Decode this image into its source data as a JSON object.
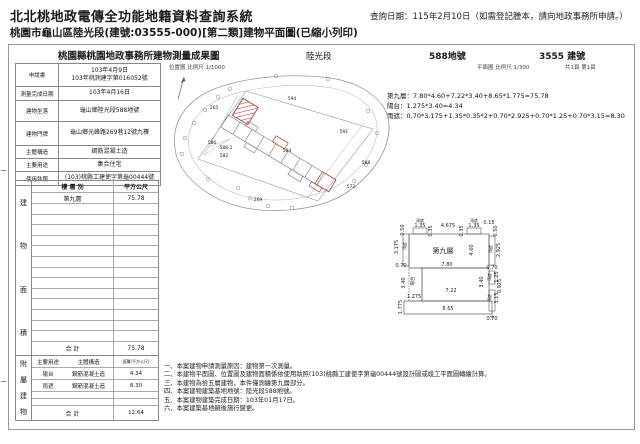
{
  "colors": {
    "accent_red": "#b0403a",
    "hatch_red": "#c05050",
    "line_gray": "#999999"
  },
  "page_header": {
    "system_title": "北北桃地政電傳全功能地籍資料查詢系統",
    "query_date": "查詢日期：115年2月10日（如需登記謄本，請向地政事務所申請。）",
    "subtitle": "桃園市龜山區陸光段(建號:03555-000)[第二類]建物平面圖(已縮小列印)"
  },
  "doc_header": {
    "office_title": "桃園縣桃園地政事務所建物測量成果圖",
    "section": "陸光段",
    "parcel": "588地號",
    "building_no": "3555 建號",
    "location_scale": "位置圖 比例尺 1/1000",
    "plan_scale": "平面圖 比例尺 1/300",
    "pages": "共1頁 第1頁"
  },
  "info_table": {
    "rows": [
      {
        "label": "申請書",
        "value": "103年4月9日\n103年桃測建字第016052號"
      },
      {
        "label": "測量完成日期",
        "value": "103年4月16日"
      },
      {
        "label": "建物坐落",
        "value": "龜山鄉陸光段588地號"
      },
      {
        "label": "建物門牌",
        "value": "龜山鄉光峰路269巷12號九樓"
      },
      {
        "label": "主體構造",
        "value": "鋼筋混凝土造"
      },
      {
        "label": "主要用途",
        "value": "集合住宅"
      },
      {
        "label": "使用執照",
        "value": "(103)桃縣工建使字第龜00444號"
      }
    ]
  },
  "floor_table": {
    "side_label": "建物面積",
    "col_floor": "樓 層 別",
    "col_area": "平方公尺",
    "rows": [
      {
        "floor": "第九層",
        "area": "75.78"
      }
    ],
    "empty_rows": 13,
    "total_label": "合  計",
    "total": "75.78"
  },
  "annex_table": {
    "side_label": "附屬建物",
    "col_use": "主要用途",
    "col_struct": "主體構造",
    "col_area": "面積(平方公尺)",
    "rows": [
      {
        "use": "陽台",
        "struct": "鋼筋混凝土造",
        "area": "4.34"
      },
      {
        "use": "雨遮",
        "struct": "鋼筋混凝土造",
        "area": "8.30"
      }
    ],
    "empty_rows": 2,
    "total_label": "合  計",
    "total": "12.64"
  },
  "calculations": {
    "line1": "第九層：7.80*4.60+7.22*3.40+8.65*1.775=75.78",
    "line2": "陽台：1.275*3.40=4.34",
    "line3": "雨遮：0.70*3.175+1.35*0.35*2+0.70*2.925+0.70*1.25+0.70*3.15=8.30"
  },
  "notes": [
    "一、本案建物申請測量原因：建物第一次測量。",
    "二、本建物平面圖、位置圖及建物面積係依使用執照(103)桃縣工建使字第龜00444號設計圖或竣工平面圖轉繪計算。",
    "三、本建物為拾五層建物，本件僅測繪第九層部分。",
    "四、本案建物建築基地地號：陸光段588地號。",
    "五、本案建物建築完成日期：103年01月17日。",
    "六、本案建築基地嗣後施行變更。"
  ],
  "location_map": {
    "labels": [
      {
        "t": "265",
        "x": 46,
        "y": 40
      },
      {
        "t": "594",
        "x": 124,
        "y": 31
      },
      {
        "t": "591",
        "x": 176,
        "y": 64
      },
      {
        "t": "586",
        "x": 44,
        "y": 75
      },
      {
        "t": "588-1",
        "x": 58,
        "y": 80
      },
      {
        "t": "582",
        "x": 56,
        "y": 88
      },
      {
        "t": "584",
        "x": 119,
        "y": 83
      },
      {
        "t": "588",
        "x": 198,
        "y": 95
      },
      {
        "t": "572",
        "x": 183,
        "y": 119
      },
      {
        "t": "269",
        "x": 90,
        "y": 132
      }
    ],
    "points": [
      [
        62,
        20
      ],
      [
        50,
        28
      ],
      [
        37,
        41
      ],
      [
        26,
        54
      ],
      [
        17,
        69
      ],
      [
        14,
        85
      ],
      [
        40,
        110
      ],
      [
        70,
        119
      ],
      [
        82,
        129
      ],
      [
        100,
        137
      ],
      [
        124,
        139
      ],
      [
        186,
        112
      ],
      [
        198,
        96
      ],
      [
        209,
        64
      ],
      [
        200,
        42
      ],
      [
        160,
        10
      ],
      [
        108,
        7
      ]
    ]
  },
  "floor_plan": {
    "dims": [
      {
        "t": "雨遮",
        "x": 29,
        "y": 6,
        "s": 3.8
      },
      {
        "t": "1.35",
        "x": 29,
        "y": 11
      },
      {
        "t": "0.35",
        "x": 41,
        "y": 15,
        "r": 1
      },
      {
        "t": "4.675",
        "x": 57,
        "y": 11
      },
      {
        "t": "雨遮",
        "x": 83,
        "y": 6,
        "s": 3.8
      },
      {
        "t": "1.35",
        "x": 83,
        "y": 11
      },
      {
        "t": "0.35",
        "x": 72,
        "y": 15,
        "r": 1
      },
      {
        "t": "0.15",
        "x": 98,
        "y": 8
      },
      {
        "t": "0.50",
        "x": 106,
        "y": 15,
        "r": 1
      },
      {
        "t": "0.50",
        "x": 13,
        "y": 14,
        "r": 1
      },
      {
        "t": "3.175",
        "x": 7,
        "y": 31,
        "r": 1
      },
      {
        "t": "雨遮",
        "x": 15,
        "y": 30,
        "r": 1,
        "s": 3.8
      },
      {
        "t": "0.70",
        "x": 10,
        "y": 51
      },
      {
        "t": "第九層",
        "x": 52,
        "y": 37,
        "s": 7
      },
      {
        "t": "4.60",
        "x": 82,
        "y": 34,
        "r": 1
      },
      {
        "t": "雨遮",
        "x": 101,
        "y": 33,
        "r": 1,
        "s": 3.8
      },
      {
        "t": "2.925",
        "x": 109,
        "y": 34,
        "r": 1
      },
      {
        "t": "7.80",
        "x": 56,
        "y": 50
      },
      {
        "t": "0.70",
        "x": 101,
        "y": 53
      },
      {
        "t": "陽台",
        "x": 23,
        "y": 65,
        "r": 1,
        "s": 4.5
      },
      {
        "t": "3.40",
        "x": 14,
        "y": 67,
        "r": 1
      },
      {
        "t": "7.22",
        "x": 60,
        "y": 76
      },
      {
        "t": "3.40",
        "x": 92,
        "y": 66,
        "r": 1
      },
      {
        "t": "雨遮",
        "x": 100,
        "y": 61,
        "r": 1,
        "s": 3.8
      },
      {
        "t": "1.25",
        "x": 107,
        "y": 61,
        "r": 1
      },
      {
        "t": "0.925",
        "x": 110,
        "y": 70,
        "r": 1
      },
      {
        "t": "1.275",
        "x": 23,
        "y": 82
      },
      {
        "t": "1.775",
        "x": 11,
        "y": 91,
        "r": 1
      },
      {
        "t": "8.65",
        "x": 57,
        "y": 94
      },
      {
        "t": "雨遮",
        "x": 100,
        "y": 82,
        "r": 1,
        "s": 3.8
      },
      {
        "t": "3.15",
        "x": 107,
        "y": 82,
        "r": 1
      },
      {
        "t": "0.70",
        "x": 101,
        "y": 104
      }
    ]
  }
}
